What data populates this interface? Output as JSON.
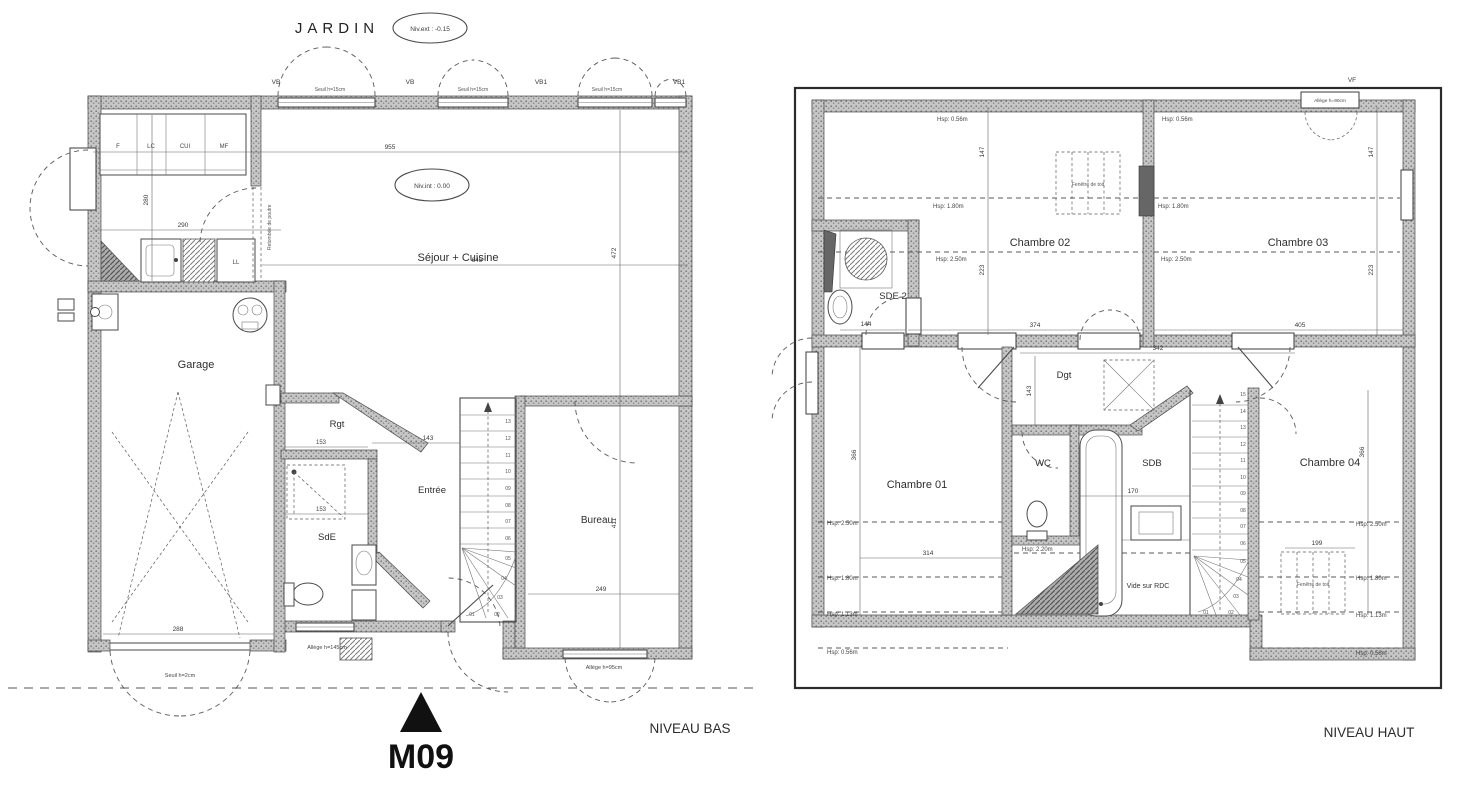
{
  "meta": {
    "jardin": "JARDIN",
    "niv_ext": "Niv.ext : -0.15",
    "niv_int": "Niv.int : 0.00",
    "model": "M09",
    "level_low": "NIVEAU BAS",
    "level_high": "NIVEAU HAUT"
  },
  "ground": {
    "window_labels": [
      "VB",
      "VB",
      "VB1",
      "VB1"
    ],
    "sill_labels": [
      "Seuil h=15cm",
      "Seuil h=15cm",
      "Seuil h=15cm"
    ],
    "kitchen_units": [
      "F",
      "LC",
      "CUI",
      "MF"
    ],
    "appliance_ll": "LL",
    "rooms": {
      "sejour": "Séjour + Cuisine",
      "garage": "Garage",
      "rgt": "Rgt",
      "entree": "Entrée",
      "sde": "SdE",
      "bureau": "Bureau"
    },
    "notes": {
      "beam": "Retombée de poutre",
      "seuil_garage": "Seuil h=2cm",
      "allege_entry": "Allège h=145cm",
      "allege_bureau": "Allège h=95cm"
    },
    "dims": {
      "w_kitchen_depth": "280",
      "w_garage_top": "290",
      "w_total": "955",
      "w_sejour": "645",
      "h_sejour": "472",
      "h_bureau": "411",
      "w_bureau": "249",
      "w_garage": "288",
      "w_entree": "143",
      "w_rgt_a": "153",
      "w_rgt_b": "153"
    },
    "stairs": [
      "01",
      "02",
      "03",
      "04",
      "05",
      "06",
      "07",
      "08",
      "09",
      "10",
      "11",
      "12",
      "13"
    ]
  },
  "upper": {
    "rooms": {
      "ch01": "Chambre 01",
      "ch02": "Chambre 02",
      "ch03": "Chambre 03",
      "ch04": "Chambre 04",
      "sde2": "SDE 2",
      "wc": "WC",
      "sdb": "SDB",
      "dgt": "Dgt",
      "vide": "Vide sur RDC"
    },
    "roof_window": "Fenêtre de toit",
    "window_vf": "VF",
    "allege_vf": "Allège h=90cm",
    "hsp": {
      "h056": "Hsp: 0.56m",
      "h113": "Hsp: 1.13m",
      "h180": "Hsp: 1.80m",
      "h220": "Hsp: 2.20m",
      "h250": "Hsp: 2.50m"
    },
    "dims": {
      "v_top_a": "147",
      "v_top_b": "223",
      "w_ch02": "374",
      "w_ch03": "405",
      "w_dgt": "342",
      "h_ch01": "366",
      "w_ch01": "314",
      "w_sdb": "170",
      "v_wc": "143",
      "w_sde2": "144",
      "w_roofwin": "199",
      "h_ch04": "366"
    },
    "stairs": [
      "01",
      "02",
      "03",
      "04",
      "05",
      "06",
      "07",
      "08",
      "09",
      "10",
      "11",
      "12",
      "13",
      "14",
      "15"
    ]
  }
}
